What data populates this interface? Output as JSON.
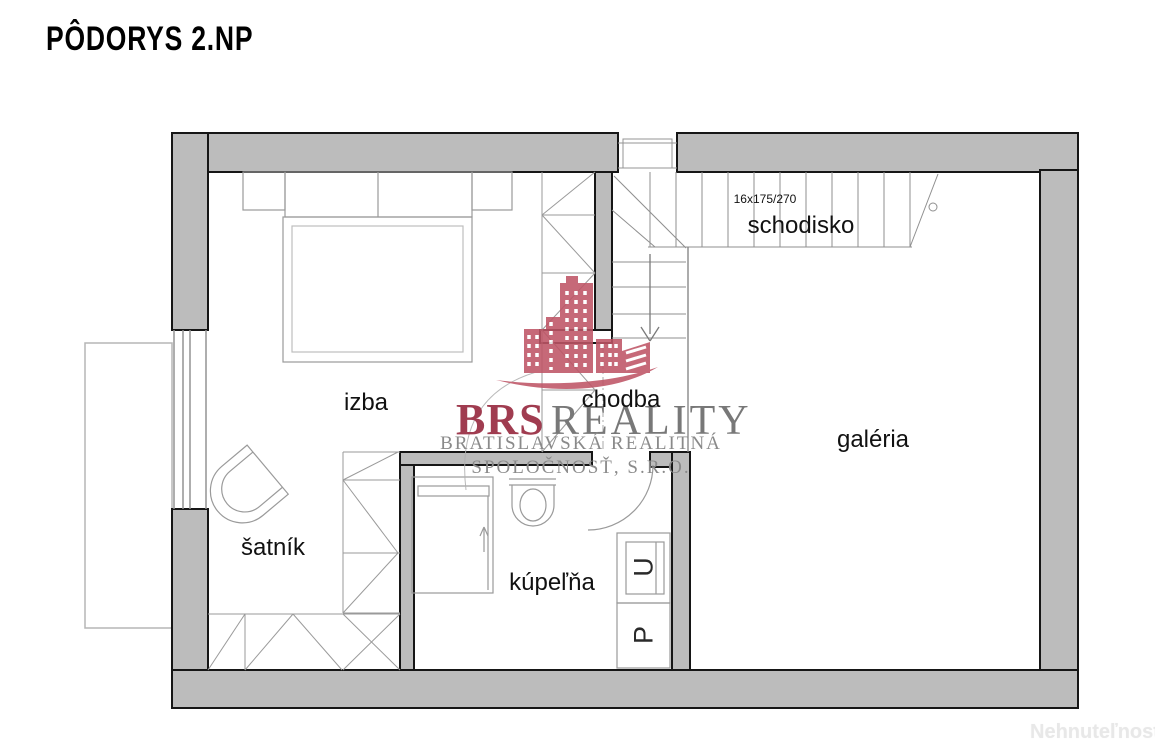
{
  "title": "PÔDORYS 2.NP",
  "rooms": {
    "izba": "izba",
    "satnik": "šatník",
    "kupelna": "kúpeľňa",
    "chodba": "chodba",
    "schodisko": "schodisko",
    "galeria": "galéria"
  },
  "stairs": {
    "spec": "16x175/270"
  },
  "appliances": {
    "u": "U",
    "p": "P"
  },
  "watermark": {
    "brand_primary": "BRS",
    "brand_secondary": "REALITY",
    "subtitle_line1": "BRATISLAVSKÁ REALITNÁ",
    "subtitle_line2": "SPOLOČNOSŤ, S.R.O."
  },
  "footer": {
    "watermark": "Nehnuteľnosti"
  },
  "colors": {
    "wall_fill": "#bcbcbc",
    "wall_outline": "#161616",
    "thin_line": "#8f8f8f",
    "logo_red": "#bf5566",
    "logo_text_red": "#a03c50",
    "logo_text_gray": "#787878",
    "page_watermark": "#e8e8e8"
  }
}
